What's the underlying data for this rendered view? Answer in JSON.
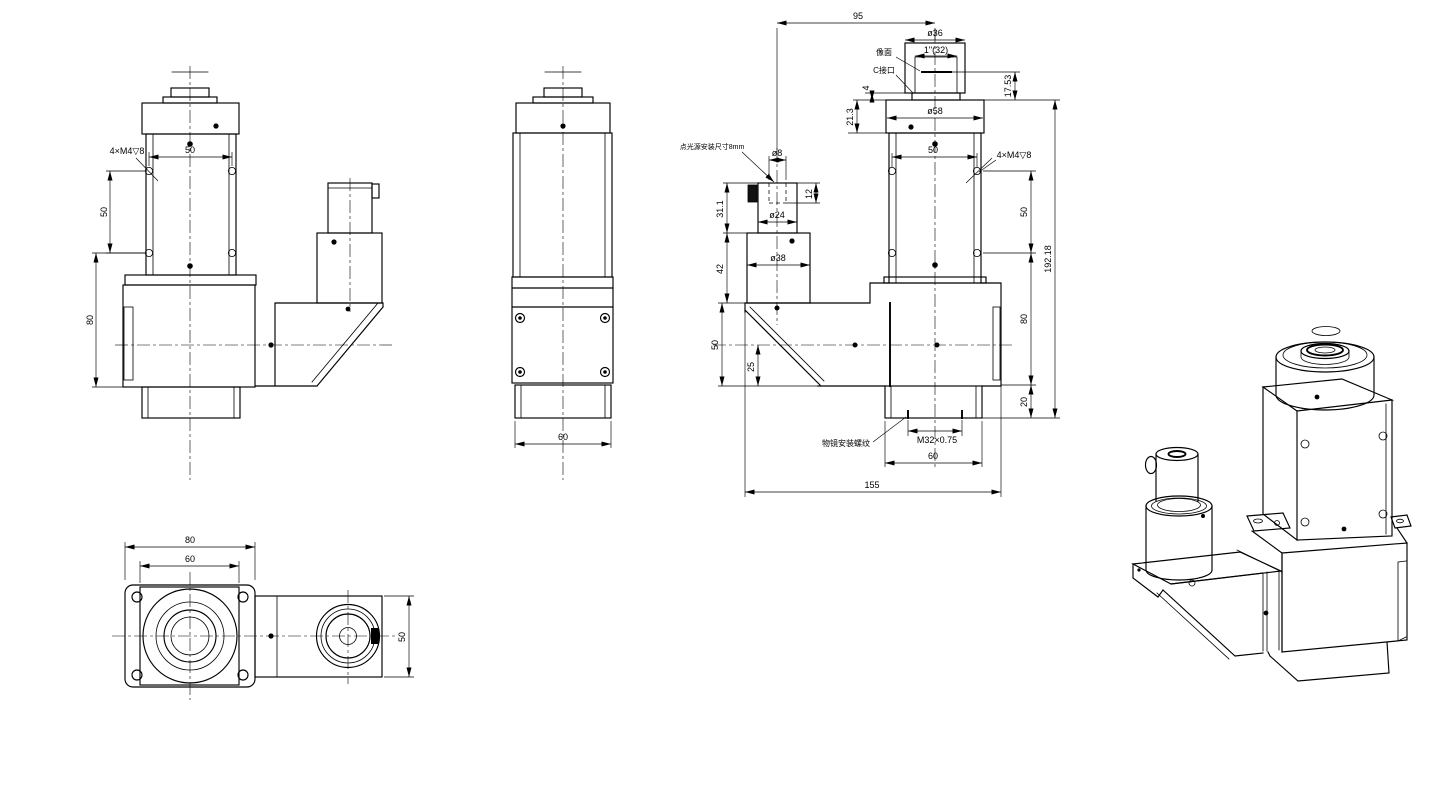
{
  "drawing": {
    "type": "mechanical-engineering-drawing",
    "subject": "coaxial light microscope objective adapter assembly",
    "line_color": "#000000",
    "background": "#ffffff"
  },
  "front_view": {
    "m4_note": "4×M4▽8",
    "hole_spacing_h": "50",
    "hole_spacing_v": "50",
    "base_height": "80"
  },
  "side_view": {
    "boss_width": "60"
  },
  "detail_view": {
    "axis_span": "95",
    "dia_adapter": "ø36",
    "inch_mount": "1\"(32)",
    "image_plane_label": "像面",
    "c_mount_label": "C接口",
    "seat_4": "4",
    "register_17_53": "17.53",
    "cap_height": "21.3",
    "dia_cap": "ø58",
    "hole_spacing_h": "50",
    "m4_note": "4×M4▽8",
    "v_50": "50",
    "v_80": "80",
    "v_20": "20",
    "total_height": "192.18",
    "light_note": "点光源安装尺寸8mm",
    "dia_pin": "ø8",
    "pin_depth": "12",
    "cyl_height": "31.1",
    "dia_cyl": "ø24",
    "block_height": "42",
    "dia_block": "ø38",
    "prism_height": "50",
    "axis_offset": "25",
    "objective_thread": "M32×0.75",
    "objective_note": "物镜安装螺纹",
    "boss_width": "60",
    "total_width": "155"
  },
  "top_view": {
    "flange_width": "80",
    "body_width": "60",
    "port_height": "50"
  }
}
